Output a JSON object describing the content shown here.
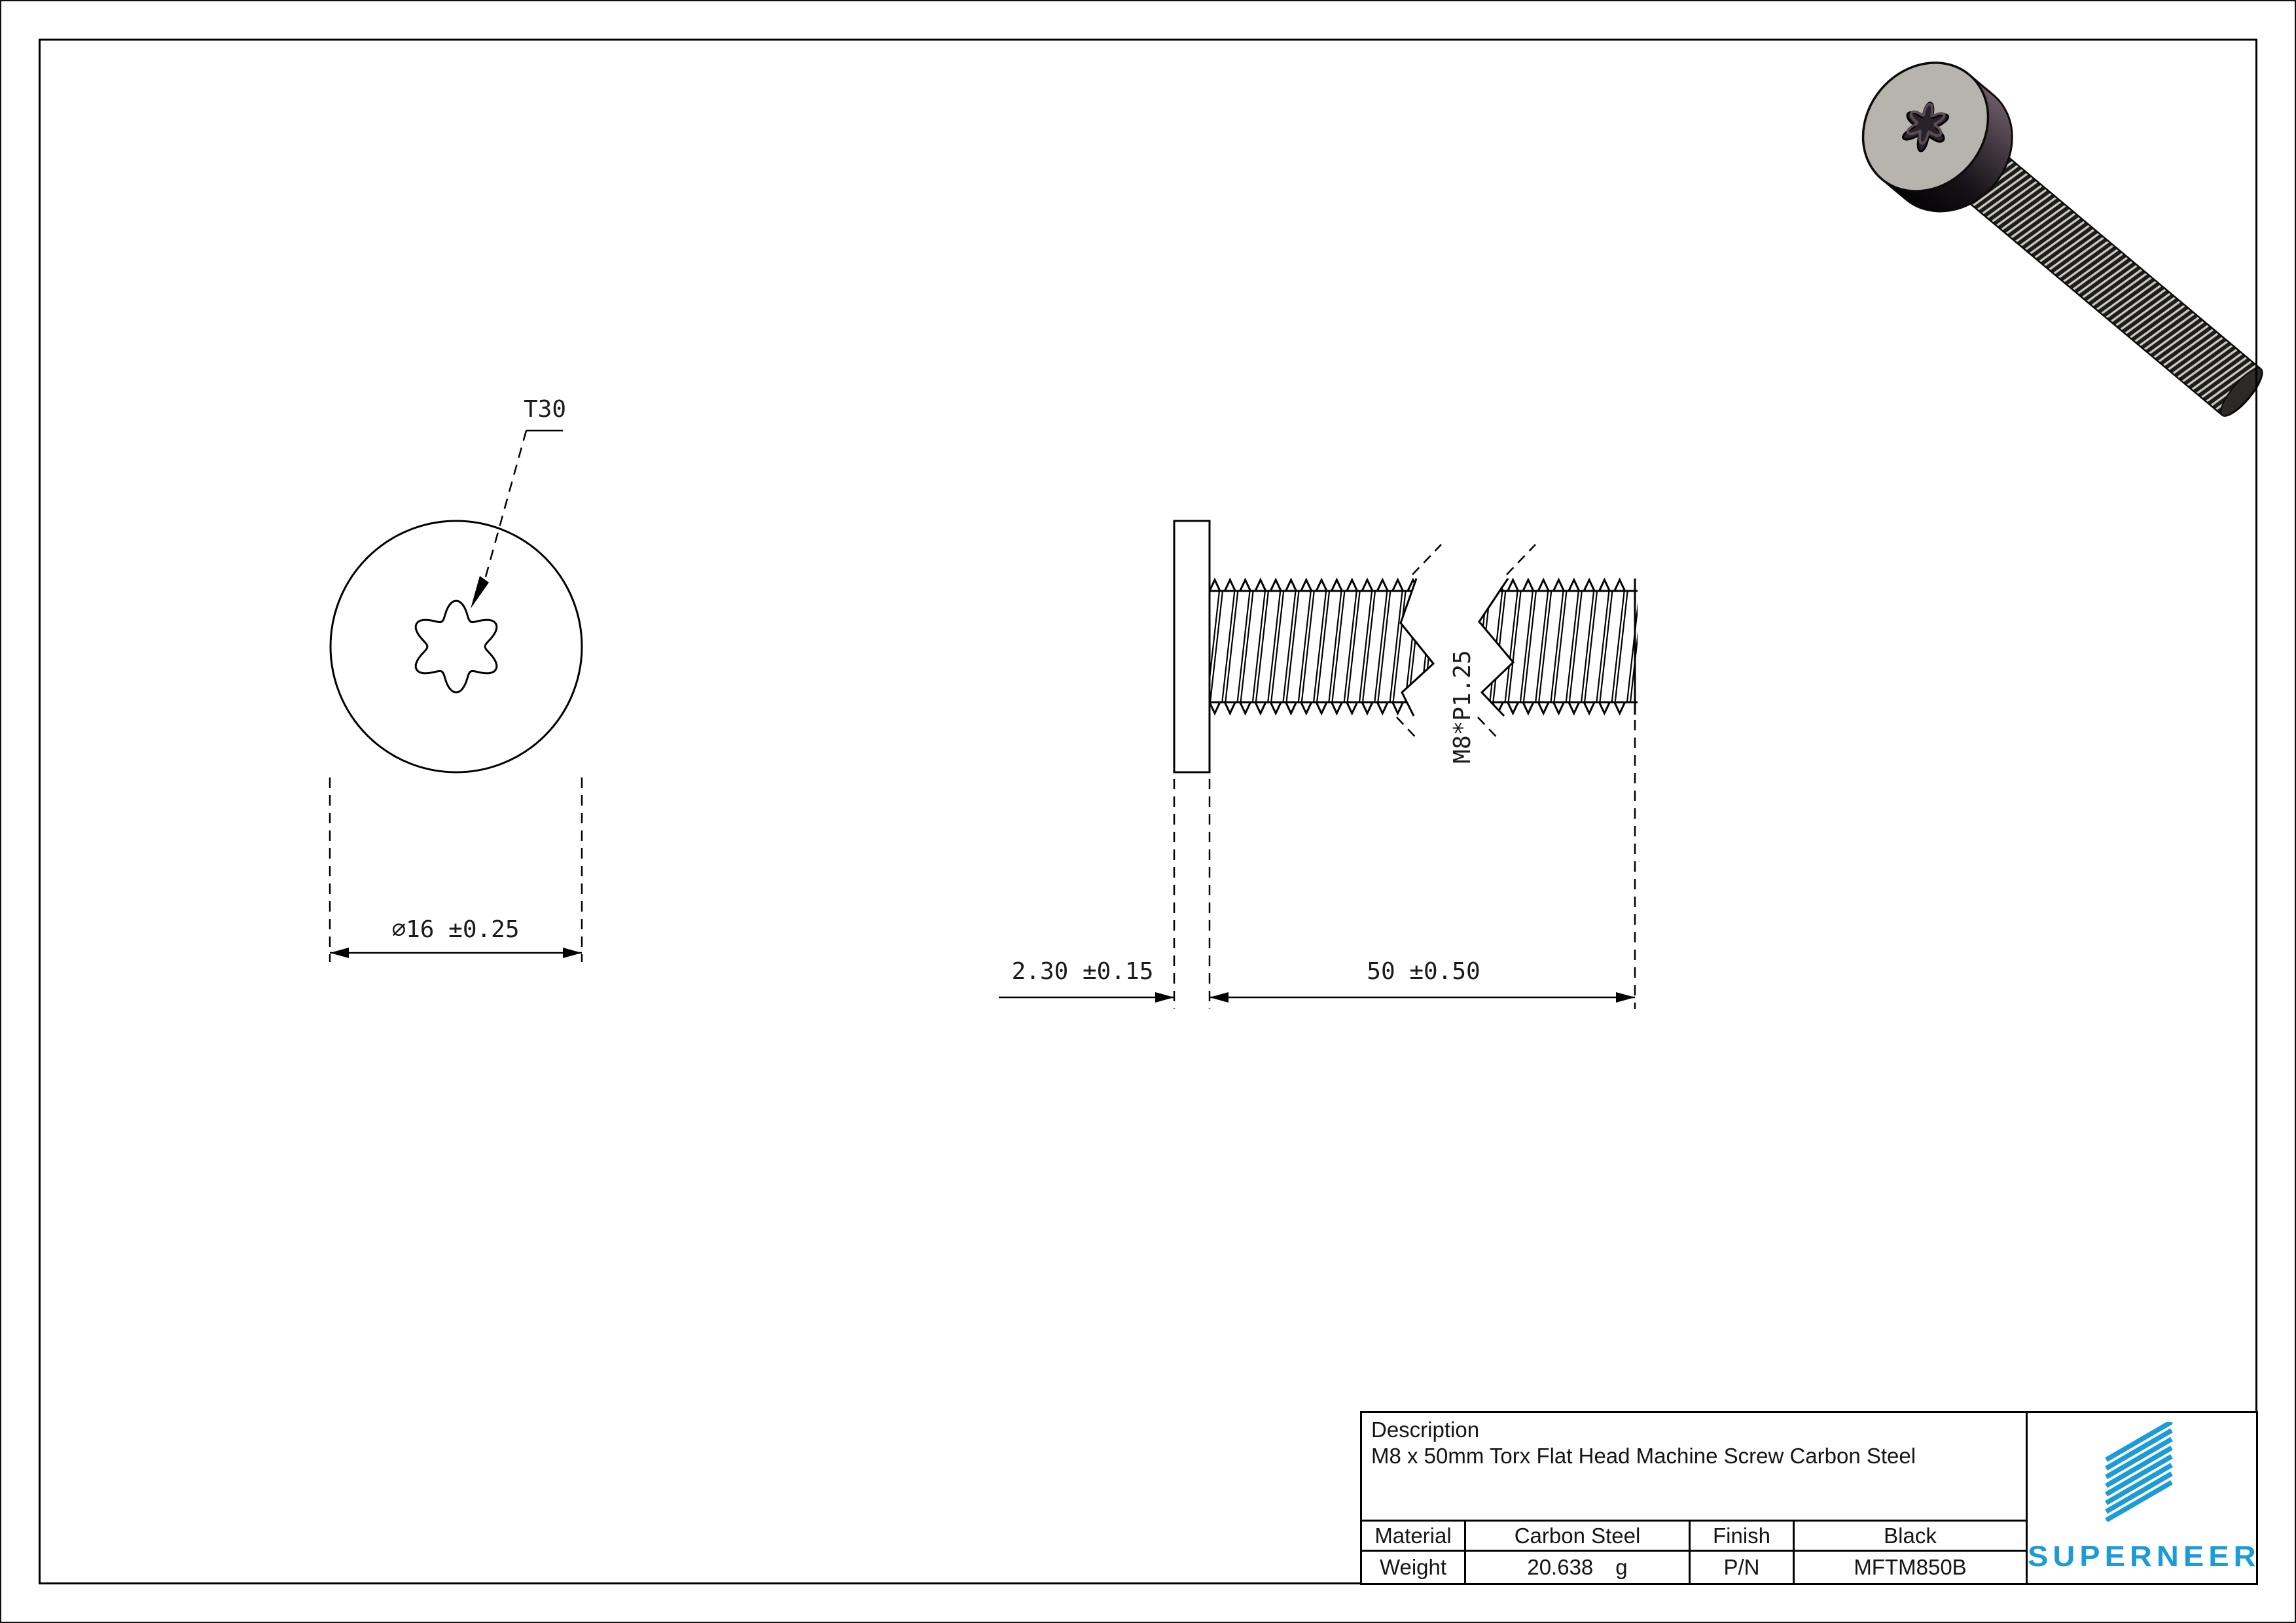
{
  "drawing": {
    "torx_label": "T30",
    "head_dia_dim": "⌀16 ±0.25",
    "head_thickness_dim": "2.30 ±0.15",
    "length_dim": "50 ±0.50",
    "thread_label": "M8*P1.25"
  },
  "title_block": {
    "description_label": "Description",
    "description": "M8 x 50mm Torx Flat Head Machine Screw Carbon Steel",
    "material_label": "Material",
    "material": "Carbon Steel",
    "finish_label": "Finish",
    "finish": "Black",
    "weight_label": "Weight",
    "weight": "20.638",
    "weight_unit": "g",
    "pn_label": "P/N",
    "pn": "MFTM850B"
  },
  "brand": {
    "name": "SUPERNEER",
    "color": "#1d9bd5",
    "logo_icon": "striped-flag-icon"
  },
  "colors": {
    "line": "#000000",
    "text": "#1a1a1a",
    "screw_face": "#b7b4ae",
    "screw_rim_dark": "#161116",
    "screw_rim_highlight": "#6b5b66",
    "thread_dark": "#1d1d1b",
    "thread_light": "#ccc9c2"
  }
}
